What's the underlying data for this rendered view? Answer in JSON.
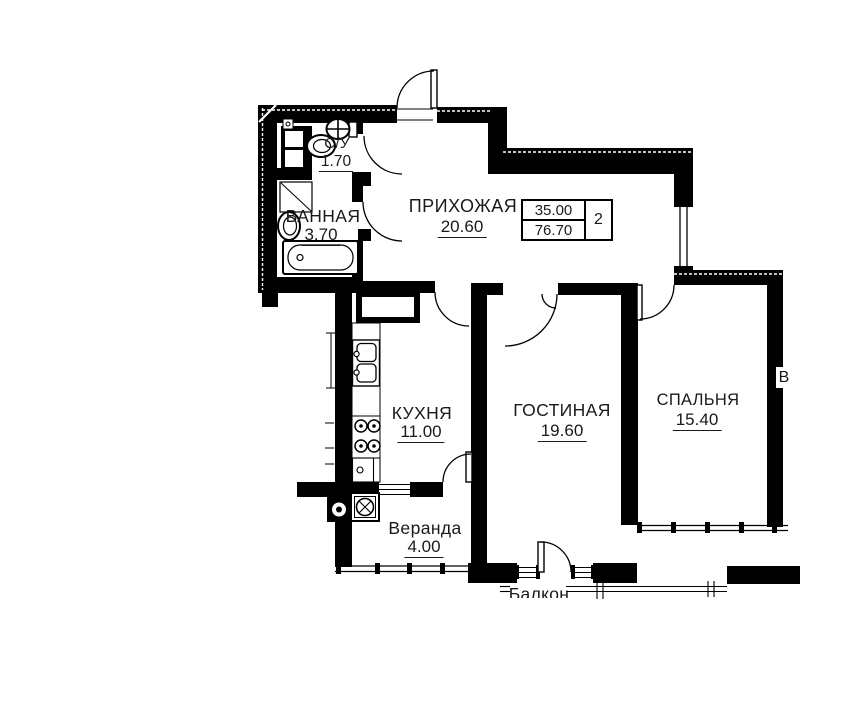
{
  "plan": {
    "rooms": [
      {
        "name": "С/У",
        "area": "1.70"
      },
      {
        "name": "ВАННАЯ",
        "area": "3.70"
      },
      {
        "name": "ПРИХОЖАЯ",
        "area": "20.60"
      },
      {
        "name": "КУХНЯ",
        "area": "11.00"
      },
      {
        "name": "ГОСТИНАЯ",
        "area": "19.60"
      },
      {
        "name": "СПАЛЬНЯ",
        "area": "15.40"
      },
      {
        "name": "Веранда",
        "area": "4.00"
      },
      {
        "name": "Балкон",
        "area": ""
      }
    ],
    "stamp": {
      "living_area": "35.00",
      "total_area": "76.70",
      "room_count": "2"
    },
    "wall_label": "В",
    "colors": {
      "wall": "#000000",
      "background": "#ffffff",
      "text": "#1a1a1a"
    }
  }
}
